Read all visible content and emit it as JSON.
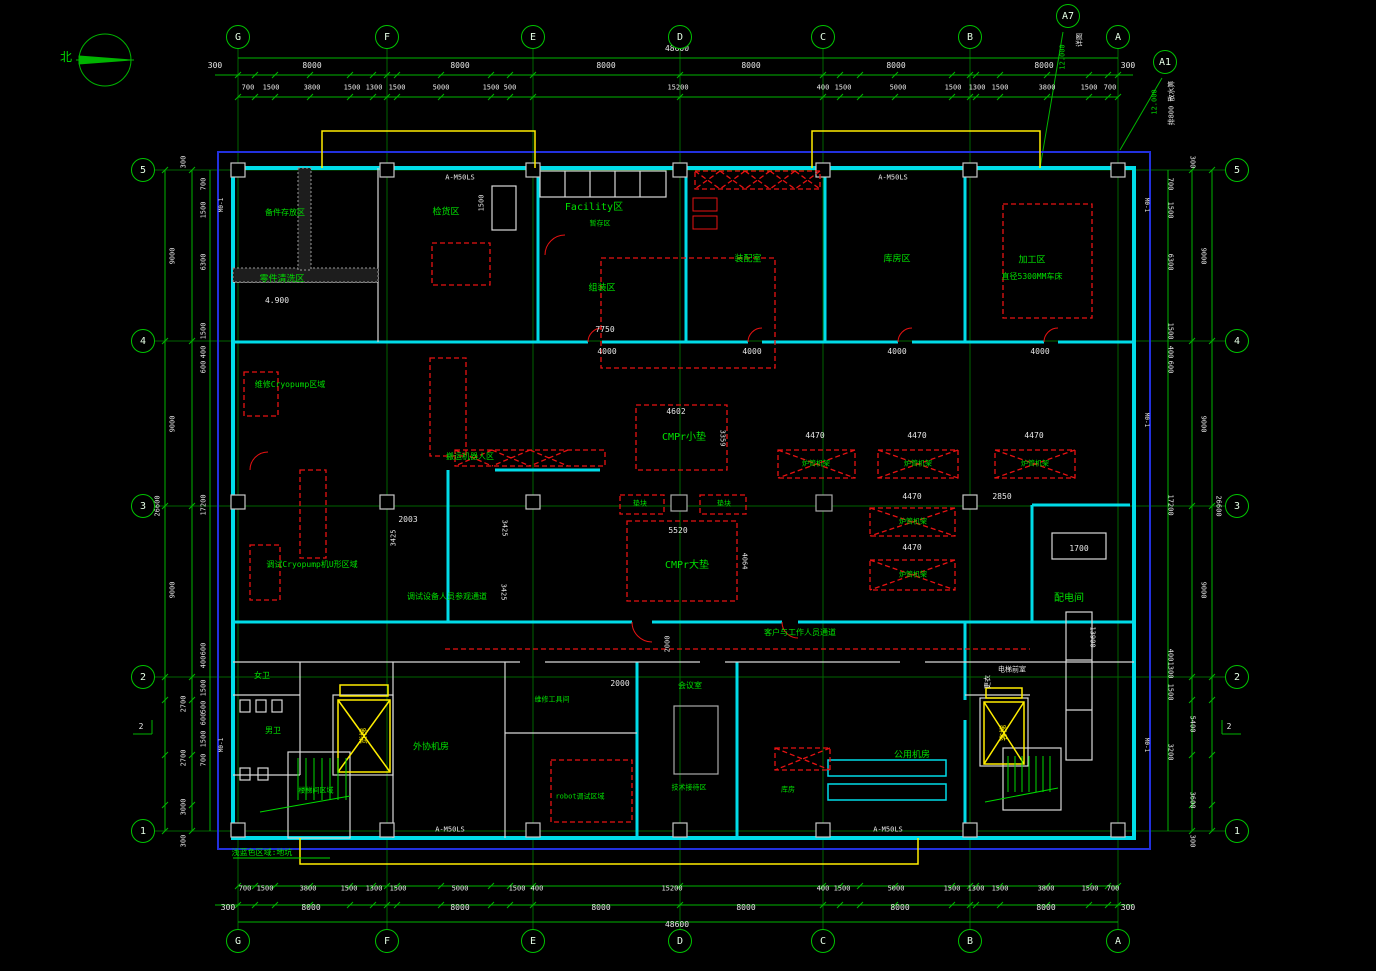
{
  "drawing": {
    "type": "floor-plan",
    "north_label": "北",
    "colors": {
      "grid": "#007400",
      "dim": "#00b400",
      "text_green": "#00e000",
      "text_white": "#e8e8e8",
      "wall_cyan": "#00dce8",
      "frame_blue": "#2230dd",
      "equip_red": "#e81212",
      "elev_yellow": "#ffee00"
    }
  },
  "grid": {
    "cols": [
      {
        "label": "G",
        "x": 238
      },
      {
        "label": "F",
        "x": 387
      },
      {
        "label": "E",
        "x": 533
      },
      {
        "label": "D",
        "x": 680
      },
      {
        "label": "C",
        "x": 823
      },
      {
        "label": "B",
        "x": 970
      },
      {
        "label": "A",
        "x": 1118
      }
    ],
    "rows": [
      {
        "label": "5",
        "y": 170
      },
      {
        "label": "4",
        "y": 341
      },
      {
        "label": "3",
        "y": 506
      },
      {
        "label": "2",
        "y": 677
      },
      {
        "label": "1",
        "y": 831
      }
    ],
    "top_y": 37,
    "bottom_y": 941,
    "left_x": 143,
    "right_x": 1237
  },
  "callouts": [
    {
      "label": "A7",
      "x": 1068,
      "y": 16
    },
    {
      "label": "A1",
      "x": 1165,
      "y": 62
    }
  ],
  "labels": [
    [
      "北",
      66,
      57,
      "g",
      12,
      0
    ],
    [
      "48600",
      677,
      49,
      "w",
      8,
      0
    ],
    [
      "300",
      215,
      66,
      "w",
      8,
      0
    ],
    [
      "8000",
      312,
      66,
      "w",
      8,
      0
    ],
    [
      "8000",
      460,
      66,
      "w",
      8,
      0
    ],
    [
      "8000",
      606,
      66,
      "w",
      8,
      0
    ],
    [
      "8000",
      751,
      66,
      "w",
      8,
      0
    ],
    [
      "8000",
      896,
      66,
      "w",
      8,
      0
    ],
    [
      "8000",
      1044,
      66,
      "w",
      8,
      0
    ],
    [
      "300",
      1128,
      66,
      "w",
      8,
      0
    ],
    [
      "700",
      248,
      88,
      "w",
      7,
      0
    ],
    [
      "1500",
      271,
      88,
      "w",
      7,
      0
    ],
    [
      "3800",
      312,
      88,
      "w",
      7,
      0
    ],
    [
      "1500",
      352,
      88,
      "w",
      7,
      0
    ],
    [
      "1300",
      374,
      88,
      "w",
      7,
      0
    ],
    [
      "1500",
      397,
      88,
      "w",
      7,
      0
    ],
    [
      "5000",
      441,
      88,
      "w",
      7,
      0
    ],
    [
      "1500",
      491,
      88,
      "w",
      7,
      0
    ],
    [
      "500",
      510,
      88,
      "w",
      7,
      0
    ],
    [
      "15200",
      678,
      88,
      "w",
      7,
      0
    ],
    [
      "400",
      823,
      88,
      "w",
      7,
      0
    ],
    [
      "1500",
      843,
      88,
      "w",
      7,
      0
    ],
    [
      "5000",
      898,
      88,
      "w",
      7,
      0
    ],
    [
      "1500",
      953,
      88,
      "w",
      7,
      0
    ],
    [
      "1300",
      977,
      88,
      "w",
      7,
      0
    ],
    [
      "1500",
      1000,
      88,
      "w",
      7,
      0
    ],
    [
      "3800",
      1047,
      88,
      "w",
      7,
      0
    ],
    [
      "1500",
      1089,
      88,
      "w",
      7,
      0
    ],
    [
      "700",
      1110,
      88,
      "w",
      7,
      0
    ],
    [
      "700",
      245,
      889,
      "w",
      7,
      0
    ],
    [
      "1500",
      265,
      889,
      "w",
      7,
      0
    ],
    [
      "3800",
      308,
      889,
      "w",
      7,
      0
    ],
    [
      "1500",
      349,
      889,
      "w",
      7,
      0
    ],
    [
      "1300",
      374,
      889,
      "w",
      7,
      0
    ],
    [
      "1500",
      398,
      889,
      "w",
      7,
      0
    ],
    [
      "5000",
      460,
      889,
      "w",
      7,
      0
    ],
    [
      "1500",
      517,
      889,
      "w",
      7,
      0
    ],
    [
      "400",
      537,
      889,
      "w",
      7,
      0
    ],
    [
      "15200",
      672,
      889,
      "w",
      7,
      0
    ],
    [
      "400",
      823,
      889,
      "w",
      7,
      0
    ],
    [
      "1500",
      842,
      889,
      "w",
      7,
      0
    ],
    [
      "5000",
      896,
      889,
      "w",
      7,
      0
    ],
    [
      "1500",
      952,
      889,
      "w",
      7,
      0
    ],
    [
      "1300",
      976,
      889,
      "w",
      7,
      0
    ],
    [
      "1500",
      1000,
      889,
      "w",
      7,
      0
    ],
    [
      "3800",
      1046,
      889,
      "w",
      7,
      0
    ],
    [
      "1500",
      1090,
      889,
      "w",
      7,
      0
    ],
    [
      "700",
      1113,
      889,
      "w",
      7,
      0
    ],
    [
      "300",
      228,
      908,
      "w",
      8,
      0
    ],
    [
      "8000",
      311,
      908,
      "w",
      8,
      0
    ],
    [
      "8000",
      460,
      908,
      "w",
      8,
      0
    ],
    [
      "8000",
      601,
      908,
      "w",
      8,
      0
    ],
    [
      "8000",
      746,
      908,
      "w",
      8,
      0
    ],
    [
      "8000",
      900,
      908,
      "w",
      8,
      0
    ],
    [
      "8000",
      1046,
      908,
      "w",
      8,
      0
    ],
    [
      "300",
      1128,
      908,
      "w",
      8,
      0
    ],
    [
      "48600",
      677,
      925,
      "w",
      8,
      0
    ],
    [
      "300",
      184,
      162,
      "w",
      7,
      -90
    ],
    [
      "9000",
      173,
      256,
      "w",
      7,
      -90
    ],
    [
      "9000",
      173,
      424,
      "w",
      7,
      -90
    ],
    [
      "9000",
      173,
      590,
      "w",
      7,
      -90
    ],
    [
      "2700",
      184,
      704,
      "w",
      7,
      -90
    ],
    [
      "2700",
      184,
      758,
      "w",
      7,
      -90
    ],
    [
      "3000",
      184,
      807,
      "w",
      7,
      -90
    ],
    [
      "300",
      184,
      841,
      "w",
      7,
      -90
    ],
    [
      "26600",
      158,
      506,
      "w",
      7,
      -90
    ],
    [
      "700",
      204,
      184,
      "w",
      7,
      -90
    ],
    [
      "1500",
      204,
      210,
      "w",
      7,
      -90
    ],
    [
      "6300",
      204,
      262,
      "w",
      7,
      -90
    ],
    [
      "1500",
      204,
      331,
      "w",
      7,
      -90
    ],
    [
      "400",
      204,
      352,
      "w",
      7,
      -90
    ],
    [
      "600",
      204,
      367,
      "w",
      7,
      -90
    ],
    [
      "17200",
      204,
      505,
      "w",
      7,
      -90
    ],
    [
      "600",
      204,
      649,
      "w",
      7,
      -90
    ],
    [
      "400",
      204,
      662,
      "w",
      7,
      -90
    ],
    [
      "1500",
      204,
      688,
      "w",
      7,
      -90
    ],
    [
      "500",
      204,
      707,
      "w",
      7,
      -90
    ],
    [
      "600",
      204,
      719,
      "w",
      7,
      -90
    ],
    [
      "1500",
      204,
      739,
      "w",
      7,
      -90
    ],
    [
      "700",
      204,
      760,
      "w",
      7,
      -90
    ],
    [
      "300",
      1192,
      162,
      "w",
      7,
      90
    ],
    [
      "9000",
      1203,
      256,
      "w",
      7,
      90
    ],
    [
      "9000",
      1203,
      424,
      "w",
      7,
      90
    ],
    [
      "9000",
      1203,
      590,
      "w",
      7,
      90
    ],
    [
      "5400",
      1192,
      724,
      "w",
      7,
      90
    ],
    [
      "3600",
      1192,
      800,
      "w",
      7,
      90
    ],
    [
      "300",
      1192,
      841,
      "w",
      7,
      90
    ],
    [
      "26600",
      1218,
      506,
      "w",
      7,
      90
    ],
    [
      "700",
      1170,
      184,
      "w",
      7,
      90
    ],
    [
      "1500",
      1170,
      210,
      "w",
      7,
      90
    ],
    [
      "6300",
      1170,
      262,
      "w",
      7,
      90
    ],
    [
      "1500",
      1170,
      331,
      "w",
      7,
      90
    ],
    [
      "400",
      1170,
      352,
      "w",
      7,
      90
    ],
    [
      "600",
      1170,
      367,
      "w",
      7,
      90
    ],
    [
      "17200",
      1170,
      505,
      "w",
      7,
      90
    ],
    [
      "400",
      1170,
      655,
      "w",
      7,
      90
    ],
    [
      "1300",
      1170,
      670,
      "w",
      7,
      90
    ],
    [
      "1500",
      1170,
      692,
      "w",
      7,
      90
    ],
    [
      "3200",
      1170,
      752,
      "w",
      7,
      90
    ],
    [
      "12.000",
      1063,
      57,
      "g",
      7,
      -90
    ],
    [
      "详图",
      1080,
      40,
      "w",
      7,
      -90
    ],
    [
      "12.000",
      1155,
      102,
      "g",
      7,
      -90
    ],
    [
      "排800 散水箅",
      1172,
      103,
      "w",
      7,
      -90
    ],
    [
      "2",
      141,
      727,
      "w",
      8,
      0
    ],
    [
      "2",
      1229,
      727,
      "w",
      8,
      0
    ],
    [
      "Facility区",
      594,
      208,
      "g",
      10,
      0
    ],
    [
      "检货区",
      446,
      213,
      "g",
      9,
      0
    ],
    [
      "暂存区",
      600,
      224,
      "g",
      7,
      0
    ],
    [
      "组装区",
      602,
      289,
      "g",
      9,
      0
    ],
    [
      "装配室",
      748,
      260,
      "g",
      9,
      0
    ],
    [
      "库房区",
      897,
      260,
      "g",
      9,
      0
    ],
    [
      "加工区",
      1032,
      261,
      "g",
      9,
      0
    ],
    [
      "直径5300MM车床",
      1032,
      277,
      "g",
      8,
      0
    ],
    [
      "备件存放区",
      285,
      213,
      "g",
      8,
      0
    ],
    [
      "零件清洗区",
      282,
      280,
      "g",
      9,
      0
    ],
    [
      "4.900",
      277,
      301,
      "w",
      8,
      0
    ],
    [
      "1500",
      482,
      203,
      "w",
      7,
      -90
    ],
    [
      "7750",
      605,
      330,
      "w",
      8,
      0
    ],
    [
      "4000",
      607,
      352,
      "w",
      8,
      0
    ],
    [
      "4000",
      752,
      352,
      "w",
      8,
      0
    ],
    [
      "4000",
      897,
      352,
      "w",
      8,
      0
    ],
    [
      "4000",
      1040,
      352,
      "w",
      8,
      0
    ],
    [
      "维修Cryopump区域",
      290,
      385,
      "g",
      8,
      0
    ],
    [
      "调试Cryopump机U形区域",
      312,
      565,
      "g",
      8,
      0
    ],
    [
      "搬运机器人区",
      470,
      457,
      "g",
      8,
      0
    ],
    [
      "调试设备人员参观通道",
      447,
      597,
      "g",
      8,
      0
    ],
    [
      "2003",
      408,
      520,
      "w",
      8,
      0
    ],
    [
      "3425",
      394,
      538,
      "w",
      7,
      -90
    ],
    [
      "3425",
      504,
      528,
      "w",
      7,
      90
    ],
    [
      "3425",
      503,
      592,
      "w",
      7,
      90
    ],
    [
      "4602",
      676,
      412,
      "w",
      8,
      0
    ],
    [
      "CMPr小垫",
      684,
      438,
      "g",
      10,
      0
    ],
    [
      "3359",
      722,
      438,
      "w",
      7,
      90
    ],
    [
      "垫块",
      640,
      504,
      "g",
      7,
      0
    ],
    [
      "垫块",
      724,
      504,
      "g",
      7,
      0
    ],
    [
      "5520",
      678,
      531,
      "w",
      8,
      0
    ],
    [
      "CMPr大垫",
      687,
      566,
      "g",
      10,
      0
    ],
    [
      "4064",
      744,
      561,
      "w",
      7,
      90
    ],
    [
      "4470",
      815,
      436,
      "w",
      8,
      0
    ],
    [
      "4470",
      917,
      436,
      "w",
      8,
      0
    ],
    [
      "4470",
      1034,
      436,
      "w",
      8,
      0
    ],
    [
      "4470",
      912,
      497,
      "w",
      8,
      0
    ],
    [
      "4470",
      912,
      548,
      "w",
      8,
      0
    ],
    [
      "2850",
      1002,
      497,
      "w",
      8,
      0
    ],
    [
      "炉管机架",
      816,
      464,
      "g",
      7,
      0
    ],
    [
      "炉管机架",
      918,
      464,
      "g",
      7,
      0
    ],
    [
      "炉管机架",
      1035,
      464,
      "g",
      7,
      0
    ],
    [
      "炉管机架",
      913,
      522,
      "g",
      7,
      0
    ],
    [
      "炉管机架",
      913,
      575,
      "g",
      7,
      0
    ],
    [
      "配电间",
      1069,
      599,
      "g",
      10,
      0
    ],
    [
      "1700",
      1079,
      549,
      "w",
      8,
      0
    ],
    [
      "13900",
      1092,
      637,
      "w",
      7,
      90
    ],
    [
      "女卫",
      262,
      676,
      "g",
      8,
      0
    ],
    [
      "男卫",
      273,
      731,
      "g",
      8,
      0
    ],
    [
      "货梯",
      364,
      736,
      "y",
      8,
      -90
    ],
    [
      "楼梯间区域",
      316,
      791,
      "g",
      7,
      0
    ],
    [
      "外协机房",
      431,
      748,
      "g",
      9,
      0
    ],
    [
      "维修工具间",
      552,
      700,
      "g",
      7,
      0
    ],
    [
      "robot调试区域",
      580,
      797,
      "g",
      7,
      0
    ],
    [
      "会议室",
      690,
      686,
      "g",
      8,
      0
    ],
    [
      "技术接待区",
      689,
      788,
      "g",
      7,
      0
    ],
    [
      "2000",
      620,
      684,
      "w",
      8,
      0
    ],
    [
      "2000",
      668,
      644,
      "w",
      7,
      -90
    ],
    [
      "客户与工作人员通道",
      800,
      633,
      "g",
      8,
      0
    ],
    [
      "库房",
      788,
      790,
      "g",
      7,
      0
    ],
    [
      "公用机房",
      912,
      756,
      "g",
      9,
      0
    ],
    [
      "更衣",
      988,
      682,
      "w",
      7,
      -90
    ],
    [
      "电梯前室",
      1012,
      670,
      "w",
      7,
      0
    ],
    [
      "客梯",
      1004,
      733,
      "y",
      8,
      -90
    ],
    [
      "浅蓝色区域:地坑",
      262,
      853,
      "g",
      8,
      0
    ],
    [
      "A-M50LS",
      460,
      178,
      "w",
      7,
      0
    ],
    [
      "A-M50LS",
      893,
      178,
      "w",
      7,
      0
    ],
    [
      "A-M50LS",
      450,
      830,
      "w",
      7,
      0
    ],
    [
      "A-M50LS",
      888,
      830,
      "w",
      7,
      0
    ],
    [
      "M0-1",
      222,
      205,
      "w",
      6,
      -90
    ],
    [
      "M0-1",
      222,
      745,
      "w",
      6,
      -90
    ],
    [
      "M0-1",
      1146,
      205,
      "w",
      6,
      90
    ],
    [
      "M0-1",
      1146,
      420,
      "w",
      6,
      90
    ],
    [
      "M0-1",
      1146,
      745,
      "w",
      6,
      90
    ]
  ]
}
